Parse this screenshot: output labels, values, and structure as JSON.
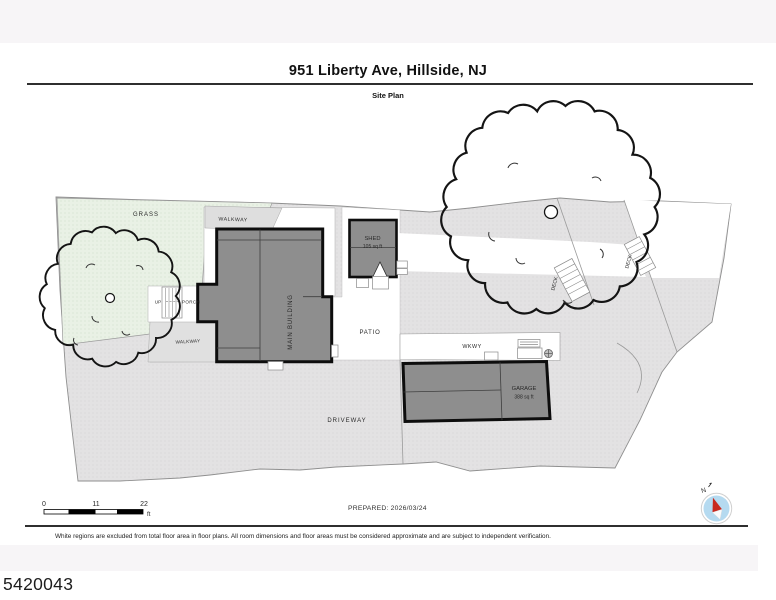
{
  "header": {
    "title": "951 Liberty Ave, Hillside, NJ",
    "subtitle": "Site Plan"
  },
  "plan": {
    "areas": {
      "grass": "GRASS",
      "walkway_upper": "WALKWAY",
      "walkway_lower": "WALKWAY",
      "patio": "PATIO",
      "driveway": "DRIVEWAY",
      "wkwy": "WKWY",
      "deck_upper": "DECK",
      "deck_lower": "DECK",
      "porch": "PORCH",
      "up": "UP"
    },
    "buildings": {
      "main": {
        "name": "MAIN BUILDING"
      },
      "shed": {
        "name": "SHED",
        "area": "105 sq ft"
      },
      "garage": {
        "name": "GARAGE",
        "area": "388 sq ft"
      }
    },
    "scale_bar": {
      "start": "0",
      "mid": "11",
      "end": "22",
      "unit": "ft"
    },
    "compass_label": "N"
  },
  "footer": {
    "prepared": "PREPARED: 2026/03/24",
    "disclaimer": "White regions are excluded from total floor area in floor plans. All room dimensions and floor areas must be considered approximate and are subject to independent verification."
  },
  "meta": {
    "listing_id": "5420043"
  },
  "colors": {
    "lot_gray": "#e3e2e3",
    "grass_green": "#e9f1e5",
    "building_gray": "#8e8e8e",
    "outline_black": "#0d0d0d",
    "compass_blue": "#b5daf0",
    "compass_red": "#c8281e"
  }
}
